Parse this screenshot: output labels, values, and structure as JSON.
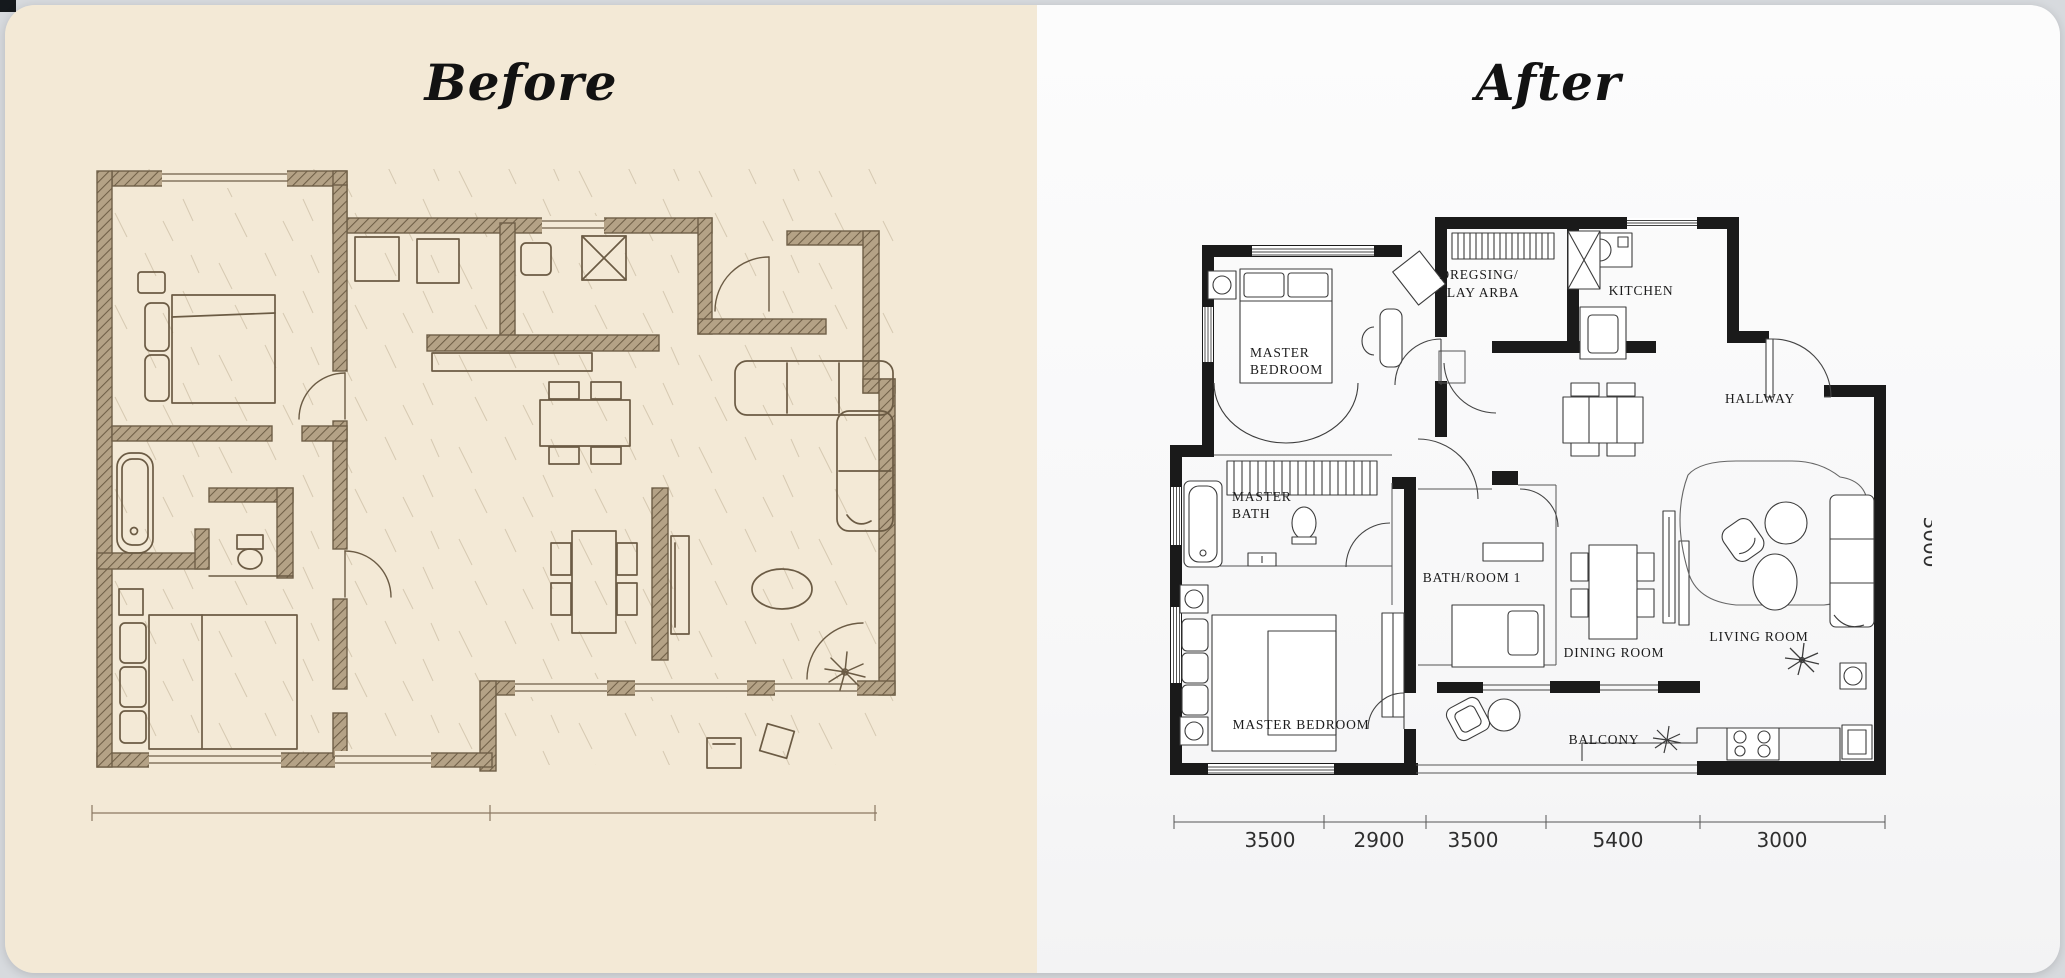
{
  "page": {
    "background": "#d7dade"
  },
  "before": {
    "title": "Before",
    "panel_color": "#f3e9d6",
    "ink_color": "#6e5d45"
  },
  "after": {
    "title": "After",
    "panel_color": "#fafafa",
    "wall_color": "#1a1a1a",
    "rooms": {
      "master_bedroom_top_1": "MASTER",
      "master_bedroom_top_2": "BEDROOM",
      "dressing_1": "DREGSING/",
      "dressing_2": "PLAY ARBA",
      "kitchen": "KITCHEN",
      "hallway": "HALLWAY",
      "master_bath_1": "MASTER",
      "master_bath_2": "BATH",
      "bathroom_1": "BATH/ROOM 1",
      "dining_room": "DINING ROOM",
      "living_room": "LIVING ROOM",
      "master_bedroom_bottom": "MASTER BEDROOM",
      "balcony": "BALCONY"
    },
    "dimensions": {
      "bottom": [
        "3500",
        "2900",
        "3500",
        "5400",
        "3000"
      ],
      "right": "3000"
    }
  }
}
